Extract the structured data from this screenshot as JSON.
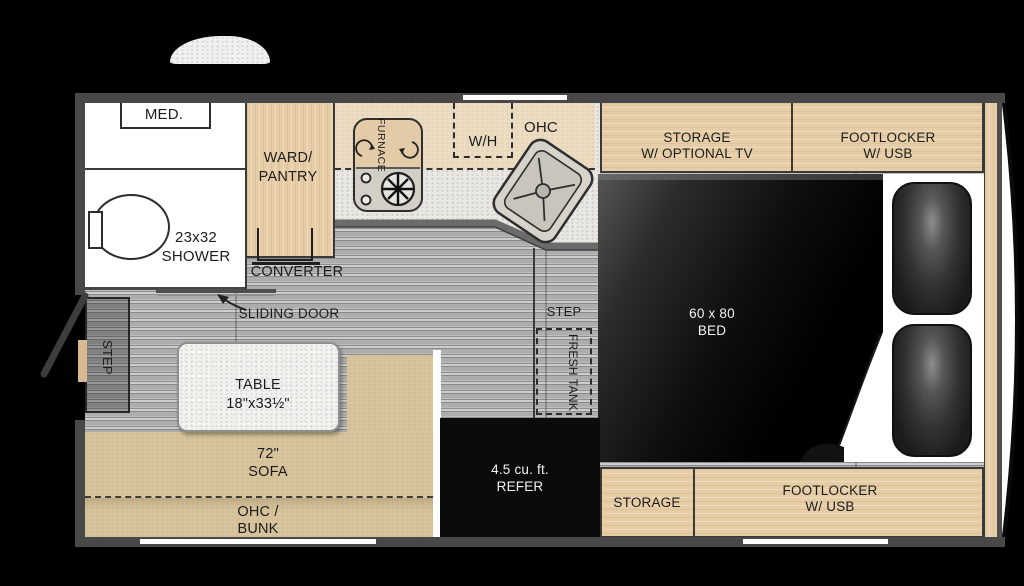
{
  "colors": {
    "background": "#000000",
    "wall": "#484848",
    "wood_cabinet": "#e6cda6",
    "wood_pale": "#ecdcc2",
    "sofa_tan": "#d8c49c",
    "floor_gray": "#a6a6a6",
    "counter_speckle": "#eae8e3",
    "bed_black": "#0c0c0c",
    "label_ink": "#1c1c1c",
    "label_light": "#f2f2f2"
  },
  "labels": {
    "med": "MED.",
    "shower1": "23x32",
    "shower2": "SHOWER",
    "ward1": "WARD/",
    "ward2": "PANTRY",
    "converter": "CONVERTER",
    "furnace": "FURNACE",
    "wh": "W/H",
    "ohc": "OHC",
    "storage_tv1": "STORAGE",
    "storage_tv2": "W/ OPTIONAL TV",
    "footlocker_top1": "FOOTLOCKER",
    "footlocker_top2": "W/ USB",
    "bed1": "60 x 80",
    "bed2": "BED",
    "sliding_door": "SLIDING DOOR",
    "step_entry": "STEP",
    "step_bed": "STEP",
    "fresh_tank": "FRESH TANK",
    "refer1": "4.5 cu. ft.",
    "refer2": "REFER",
    "table1": "TABLE",
    "table2": "18\"x33½\"",
    "sofa1": "72\"",
    "sofa2": "SOFA",
    "bunk1": "OHC /",
    "bunk2": "BUNK",
    "storage_bottom": "STORAGE",
    "footlocker_bottom1": "FOOTLOCKER",
    "footlocker_bottom2": "W/ USB"
  }
}
